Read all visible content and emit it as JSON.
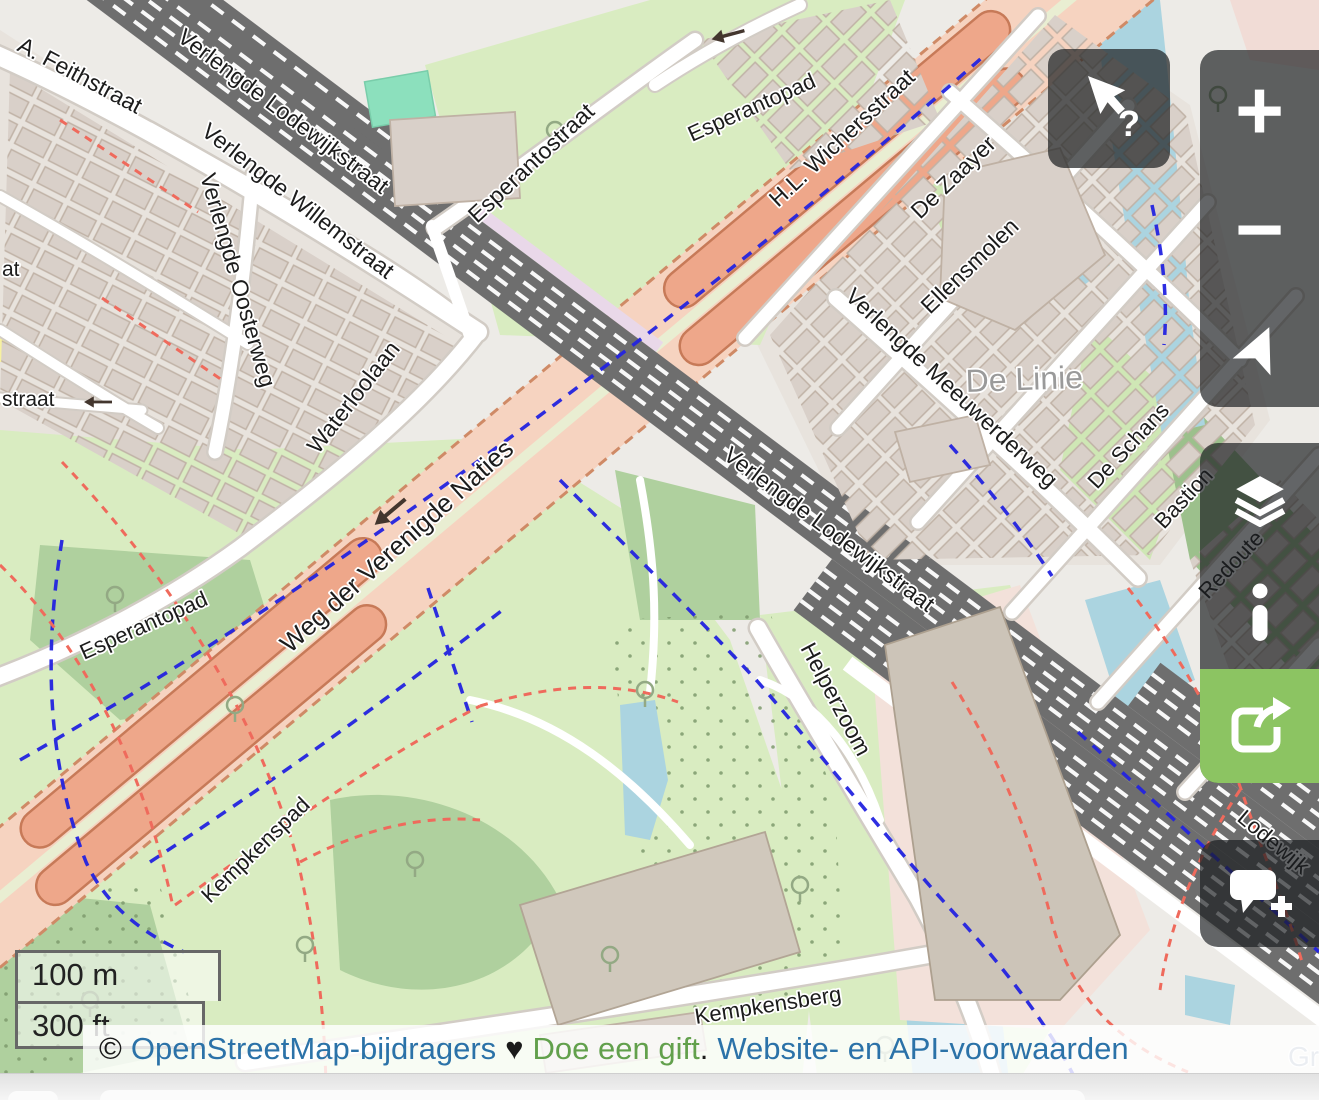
{
  "map": {
    "labels": [
      {
        "text": "A. Feithstraat"
      },
      {
        "text": "Verlengde Lodewijkstraat"
      },
      {
        "text": "Verlengde Willemstraat"
      },
      {
        "text": "Verlengde Oosterweg"
      },
      {
        "text": "at"
      },
      {
        "text": "straat"
      },
      {
        "text": "Waterloolaan"
      },
      {
        "text": "Esperantostraat"
      },
      {
        "text": "Esperantopad"
      },
      {
        "text": "H.L. Wichersstraat"
      },
      {
        "text": "De Zaayer"
      },
      {
        "text": "Ellensmolen"
      },
      {
        "text": "De Linie"
      },
      {
        "text": "Verlengde Meeuwerderweg"
      },
      {
        "text": "De Schans"
      },
      {
        "text": "Bastion"
      },
      {
        "text": "Redoute"
      },
      {
        "text": "Verlengde Lodewijkstraat"
      },
      {
        "text": "Weg der Verenigde Naties"
      },
      {
        "text": "Esperantopad"
      },
      {
        "text": "Kempkenspad"
      },
      {
        "text": "Helperzoom"
      },
      {
        "text": "Kempkensberg"
      },
      {
        "text": "Lodewijk"
      },
      {
        "text": "Gr"
      }
    ],
    "colors": {
      "background": "#edebe7",
      "residential": "#e8e3dd",
      "park_green": "#d9ecc1",
      "wood_green": "#afd09e",
      "water": "#abd4e0",
      "building": "#d9d0c9",
      "railway_gray": "#6e6e6e",
      "construction_salmon": "#eea78a",
      "construction_pale": "#f6d3c0",
      "cycleway_blue": "#2323e0",
      "footpath_red": "#ef6a5c",
      "pitch_teal": "#8ce0bd"
    }
  },
  "controls": {
    "query": {
      "icon": "cursor-query-icon",
      "question_mark": "?"
    },
    "zoom_in_label": "+",
    "zoom_out_label": "−",
    "icons": {
      "locate": "locate-arrow-icon",
      "layers": "layers-icon",
      "info": "info-icon",
      "share": "share-icon",
      "note": "add-note-icon"
    },
    "share_green": "#8cc462",
    "panel_bg": "rgba(25,28,31,0.68)"
  },
  "scale": {
    "metric": "100 m",
    "imperial": "300 ft"
  },
  "attribution": {
    "copyright": "©",
    "osm_link": "OpenStreetMap-bijdragers",
    "heart": "♥",
    "donate_link": "Doe een gift",
    "dot": ".",
    "terms_link": "Website- en API-voorwaarden"
  }
}
